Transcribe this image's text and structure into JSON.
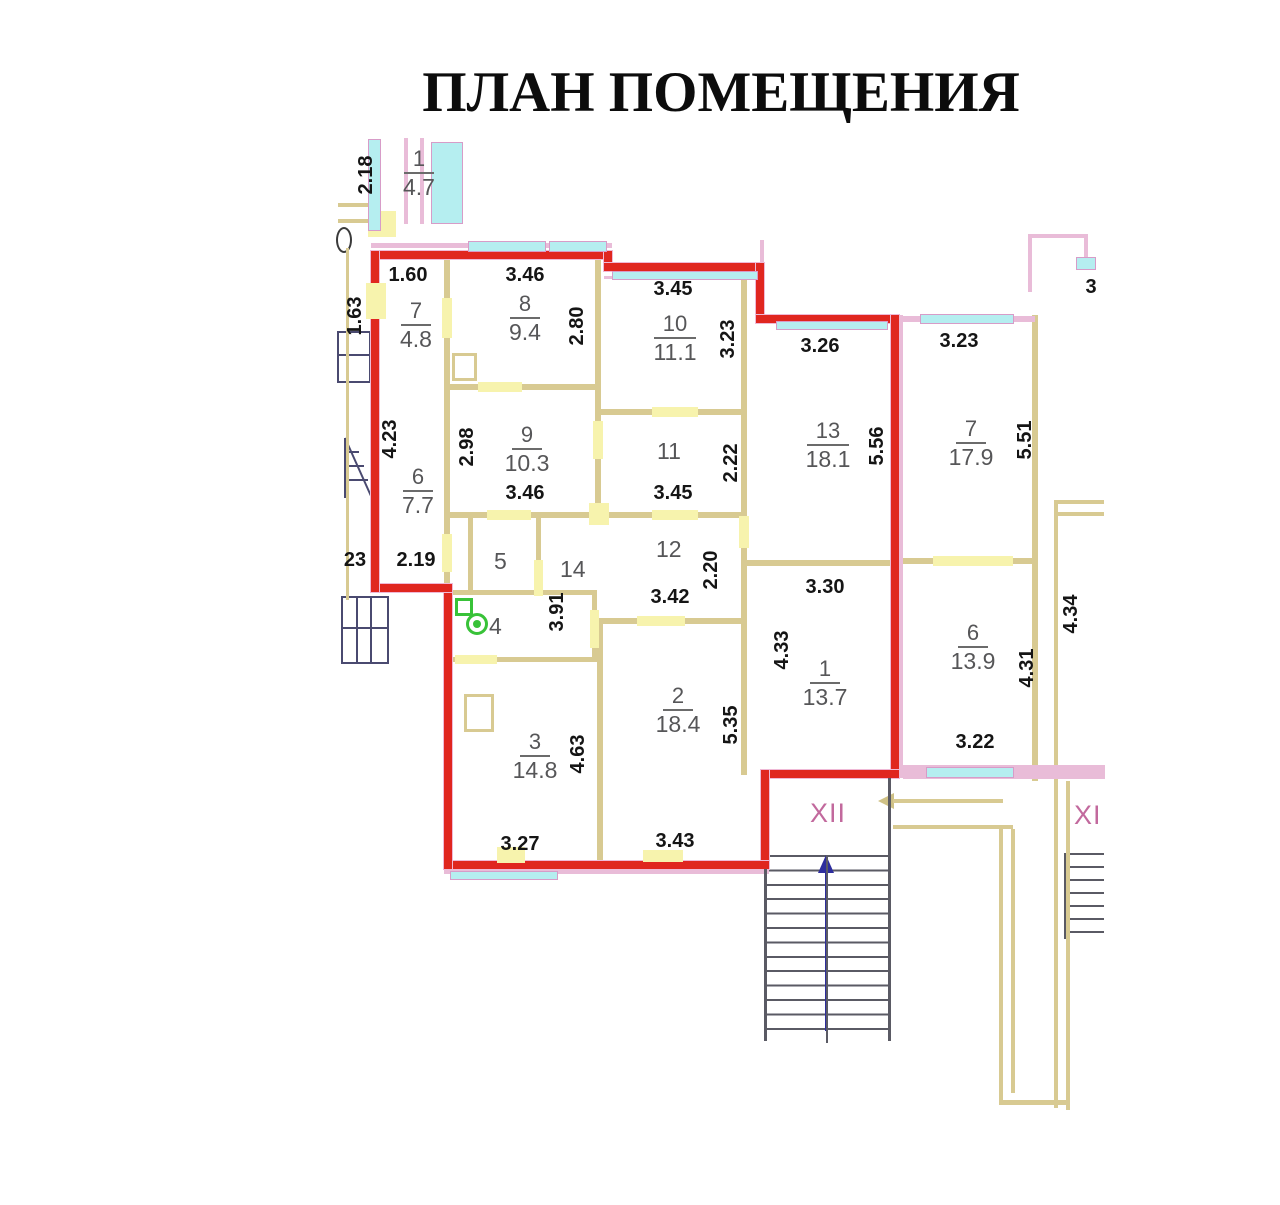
{
  "title": "ПЛАН ПОМЕЩЕНИЯ",
  "palette": {
    "boundary_red": "#e0261f",
    "wall_tan": "#d8ca92",
    "door_yellow": "#f7f3ad",
    "window_cyan": "#b5eef0",
    "wall_pink": "#e9bcd8",
    "label_gray": "#565658",
    "dim_black": "#151515",
    "stair_magenta": "#c2699d",
    "arrow_blue": "#2d2d9d",
    "fixture_green": "#38c238"
  },
  "stair_labels": [
    {
      "text": "XII",
      "x": 810,
      "y": 798
    },
    {
      "text": "XI",
      "x": 1074,
      "y": 800
    }
  ],
  "room_labels": [
    {
      "num": "1",
      "area": "4.7",
      "x": 384,
      "y": 146
    },
    {
      "num": "7",
      "area": "4.8",
      "x": 381,
      "y": 298
    },
    {
      "num": "8",
      "area": "9.4",
      "x": 490,
      "y": 291
    },
    {
      "num": "10",
      "area": "11.1",
      "x": 640,
      "y": 311
    },
    {
      "num": "13",
      "area": "18.1",
      "x": 793,
      "y": 418
    },
    {
      "num": "7",
      "area": "17.9",
      "x": 936,
      "y": 416
    },
    {
      "num": "9",
      "area": "10.3",
      "x": 492,
      "y": 422
    },
    {
      "num": "6",
      "area": "7.7",
      "x": 383,
      "y": 464
    },
    {
      "num": "6",
      "area": "13.9",
      "x": 938,
      "y": 620
    },
    {
      "num": "1",
      "area": "13.7",
      "x": 790,
      "y": 656
    },
    {
      "num": "2",
      "area": "18.4",
      "x": 643,
      "y": 683
    },
    {
      "num": "3",
      "area": "14.8",
      "x": 500,
      "y": 729
    }
  ],
  "room_numbers": [
    {
      "text": "11",
      "x": 657,
      "y": 438
    },
    {
      "text": "12",
      "x": 656,
      "y": 536
    },
    {
      "text": "5",
      "x": 494,
      "y": 548
    },
    {
      "text": "14",
      "x": 560,
      "y": 556
    },
    {
      "text": "4",
      "x": 489,
      "y": 613
    }
  ],
  "dims": [
    {
      "text": "2.18",
      "x": 366,
      "y": 175,
      "rot": true
    },
    {
      "text": "1.60",
      "x": 408,
      "y": 275
    },
    {
      "text": "3.46",
      "x": 525,
      "y": 275
    },
    {
      "text": "1.63",
      "x": 355,
      "y": 316,
      "rot": true
    },
    {
      "text": "2.80",
      "x": 577,
      "y": 326,
      "rot": true
    },
    {
      "text": "3.45",
      "x": 673,
      "y": 289
    },
    {
      "text": "3.23",
      "x": 728,
      "y": 339,
      "rot": true
    },
    {
      "text": "3.26",
      "x": 820,
      "y": 346
    },
    {
      "text": "5.56",
      "x": 877,
      "y": 446,
      "rot": true
    },
    {
      "text": "3.23",
      "x": 959,
      "y": 341
    },
    {
      "text": "5.51",
      "x": 1025,
      "y": 440,
      "rot": true
    },
    {
      "text": "3",
      "x": 1091,
      "y": 287
    },
    {
      "text": "4.23",
      "x": 390,
      "y": 439,
      "rot": true
    },
    {
      "text": "2.98",
      "x": 467,
      "y": 447,
      "rot": true
    },
    {
      "text": "2.22",
      "x": 731,
      "y": 463,
      "rot": true
    },
    {
      "text": "3.46",
      "x": 525,
      "y": 493
    },
    {
      "text": "3.45",
      "x": 673,
      "y": 493
    },
    {
      "text": "23",
      "x": 355,
      "y": 560
    },
    {
      "text": "2.19",
      "x": 416,
      "y": 560
    },
    {
      "text": "3.91",
      "x": 557,
      "y": 612,
      "rot": true
    },
    {
      "text": "3.42",
      "x": 670,
      "y": 597
    },
    {
      "text": "2.20",
      "x": 711,
      "y": 570,
      "rot": true
    },
    {
      "text": "3.30",
      "x": 825,
      "y": 587
    },
    {
      "text": "4.33",
      "x": 782,
      "y": 650,
      "rot": true
    },
    {
      "text": "4.63",
      "x": 578,
      "y": 754,
      "rot": true
    },
    {
      "text": "5.35",
      "x": 731,
      "y": 725,
      "rot": true
    },
    {
      "text": "4.31",
      "x": 1027,
      "y": 668,
      "rot": true
    },
    {
      "text": "4.34",
      "x": 1071,
      "y": 614,
      "rot": true
    },
    {
      "text": "3.22",
      "x": 975,
      "y": 742
    },
    {
      "text": "3.27",
      "x": 520,
      "y": 844
    },
    {
      "text": "3.43",
      "x": 675,
      "y": 841
    }
  ],
  "geometry": {
    "walls": [
      [
        444,
        251,
        6,
        337
      ],
      [
        450,
        384,
        147,
        6
      ],
      [
        595,
        251,
        6,
        267
      ],
      [
        601,
        409,
        142,
        6
      ],
      [
        450,
        512,
        296,
        6
      ],
      [
        741,
        263,
        6,
        512
      ],
      [
        747,
        560,
        146,
        6
      ],
      [
        468,
        518,
        5,
        76
      ],
      [
        536,
        518,
        5,
        76
      ],
      [
        450,
        590,
        147,
        5
      ],
      [
        592,
        590,
        5,
        72
      ],
      [
        450,
        657,
        153,
        5
      ],
      [
        597,
        618,
        6,
        247
      ],
      [
        603,
        618,
        140,
        6
      ],
      [
        1032,
        315,
        6,
        250
      ],
      [
        895,
        558,
        140,
        6
      ],
      [
        1032,
        563,
        6,
        218
      ],
      [
        1054,
        500,
        4,
        608
      ],
      [
        1066,
        781,
        4,
        329
      ],
      [
        1057,
        500,
        47,
        4
      ],
      [
        1057,
        512,
        47,
        4
      ],
      [
        999,
        829,
        4,
        276
      ],
      [
        1011,
        829,
        4,
        264
      ],
      [
        1001,
        1100,
        68,
        5
      ],
      [
        346,
        248,
        3,
        352
      ],
      [
        338,
        203,
        40,
        4
      ],
      [
        338,
        219,
        32,
        4
      ],
      [
        893,
        799,
        110,
        4
      ],
      [
        893,
        825,
        120,
        4
      ]
    ],
    "pink": [
      [
        371,
        243,
        241,
        5
      ],
      [
        604,
        276,
        160,
        3
      ],
      [
        899,
        315,
        4,
        463
      ],
      [
        444,
        869,
        325,
        5
      ],
      [
        903,
        765,
        202,
        14
      ],
      [
        404,
        138,
        4,
        86
      ],
      [
        420,
        138,
        4,
        86
      ],
      [
        895,
        316,
        140,
        6
      ],
      [
        1028,
        234,
        4,
        58
      ],
      [
        1028,
        234,
        60,
        4
      ],
      [
        1084,
        234,
        4,
        26
      ],
      [
        760,
        240,
        4,
        25
      ]
    ],
    "red": [
      [
        371,
        251,
        241,
        8
      ],
      [
        604,
        251,
        8,
        20
      ],
      [
        604,
        263,
        160,
        8
      ],
      [
        756,
        263,
        8,
        60
      ],
      [
        756,
        315,
        143,
        8
      ],
      [
        891,
        315,
        8,
        463
      ],
      [
        761,
        770,
        138,
        8
      ],
      [
        761,
        770,
        8,
        99
      ],
      [
        444,
        861,
        325,
        8
      ],
      [
        444,
        588,
        8,
        281
      ],
      [
        371,
        584,
        81,
        8
      ],
      [
        371,
        251,
        8,
        341
      ]
    ],
    "doors": [
      [
        442,
        298,
        10,
        40
      ],
      [
        478,
        382,
        44,
        10
      ],
      [
        593,
        421,
        10,
        38
      ],
      [
        652,
        407,
        46,
        10
      ],
      [
        487,
        510,
        44,
        10
      ],
      [
        652,
        510,
        46,
        10
      ],
      [
        739,
        516,
        10,
        32
      ],
      [
        534,
        560,
        9,
        36
      ],
      [
        590,
        610,
        9,
        38
      ],
      [
        455,
        655,
        42,
        9
      ],
      [
        637,
        616,
        48,
        10
      ],
      [
        933,
        556,
        80,
        10
      ],
      [
        442,
        534,
        10,
        38
      ],
      [
        368,
        211,
        28,
        26
      ],
      [
        366,
        283,
        20,
        36
      ],
      [
        589,
        503,
        20,
        22
      ],
      [
        497,
        847,
        28,
        16
      ],
      [
        643,
        850,
        40,
        12
      ]
    ],
    "windows": [
      [
        468,
        241,
        78,
        11
      ],
      [
        549,
        241,
        58,
        11
      ],
      [
        612,
        271,
        146,
        9
      ],
      [
        776,
        321,
        112,
        9
      ],
      [
        920,
        314,
        94,
        10
      ],
      [
        1076,
        257,
        20,
        13
      ],
      [
        926,
        767,
        88,
        11
      ],
      [
        450,
        871,
        108,
        9
      ],
      [
        368,
        139,
        13,
        92
      ],
      [
        431,
        142,
        32,
        82
      ]
    ],
    "grays": [
      [
        764,
        869,
        3,
        172
      ],
      [
        888,
        778,
        3,
        263
      ],
      [
        826,
        855,
        2,
        188
      ],
      [
        1064,
        853,
        2,
        86
      ]
    ]
  }
}
